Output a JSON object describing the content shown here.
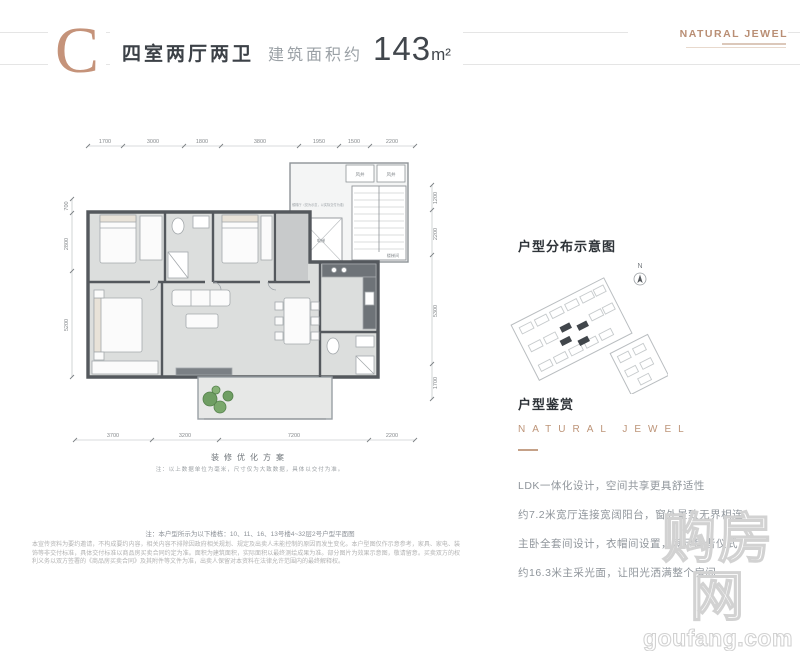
{
  "header": {
    "type_letter": "C",
    "title": "四室两厅两卫",
    "area_label": "建筑面积约",
    "area_value": "143",
    "area_unit": "m²",
    "brand": "NATURAL JEWEL"
  },
  "plan": {
    "dims_top": [
      "1700",
      "3000",
      "1800",
      "3800",
      "1950",
      "1500",
      "2200"
    ],
    "dims_bottom": [
      "3700",
      "3200",
      "7200",
      "2200"
    ],
    "dims_left": [
      "700",
      "2800",
      "5200"
    ],
    "dims_right": [
      "1200",
      "2200",
      "5300",
      "1700"
    ],
    "labels": {
      "lobby": "候梯厅（仅为示意，以实际交付为准）",
      "elevator": "电梯",
      "stairs": "楼梯间",
      "shaft_1": "风井",
      "shaft_2": "风井"
    },
    "caption": "装修优化方案",
    "caption_note": "注：以上数据单位为毫米，尺寸仅为大致数据，具体以交付为准。"
  },
  "sidebar": {
    "distribution_title": "户型分布示意图",
    "compass_label": "N",
    "appreciation_title": "户型鉴赏",
    "brand": "NATURAL JEWEL",
    "paragraph": [
      "LDK一体化设计，空间共享更具舒适性",
      "约7.2米宽厅连接宽阔阳台，窗外景致无界相连",
      "主卧全套间设计，衣帽间设置，满足居者仪式",
      "约16.3米主采光面，让阳光洒满整个房间"
    ]
  },
  "footer": {
    "note": "注：本户型所示为以下楼栋：10、11、16、13号楼4~32层2号户型平面图",
    "disclaimer": "本宣传资料为要约邀请，不构成要约内容，相关内容不排除因政府相关规划、规定及出卖人未能控制的原因而发生变化。本户型图仅作示意参考，家具、家电、装饰等非交付标准，具体交付标准以商品房买卖合同约定为准。面积为建筑面积，实际面积以最终测绘成果为准。部分图片为效果示意图，敬请留意。买卖双方的权利义务以双方签署的《商品房买卖合同》及其附件等文件为准，出卖人保留对本资料在法律允许范围内的最终解释权。"
  },
  "watermark": {
    "cn": "购房网",
    "en": "goufang.com"
  },
  "colors": {
    "accent": "#bd8e72",
    "wall": "#54585d",
    "floor": "#dcdedd",
    "plant": "#6f9e63",
    "text_dark": "#3b4046",
    "text_gray": "#9aa0a5",
    "watermark": "#d2d2d2"
  }
}
